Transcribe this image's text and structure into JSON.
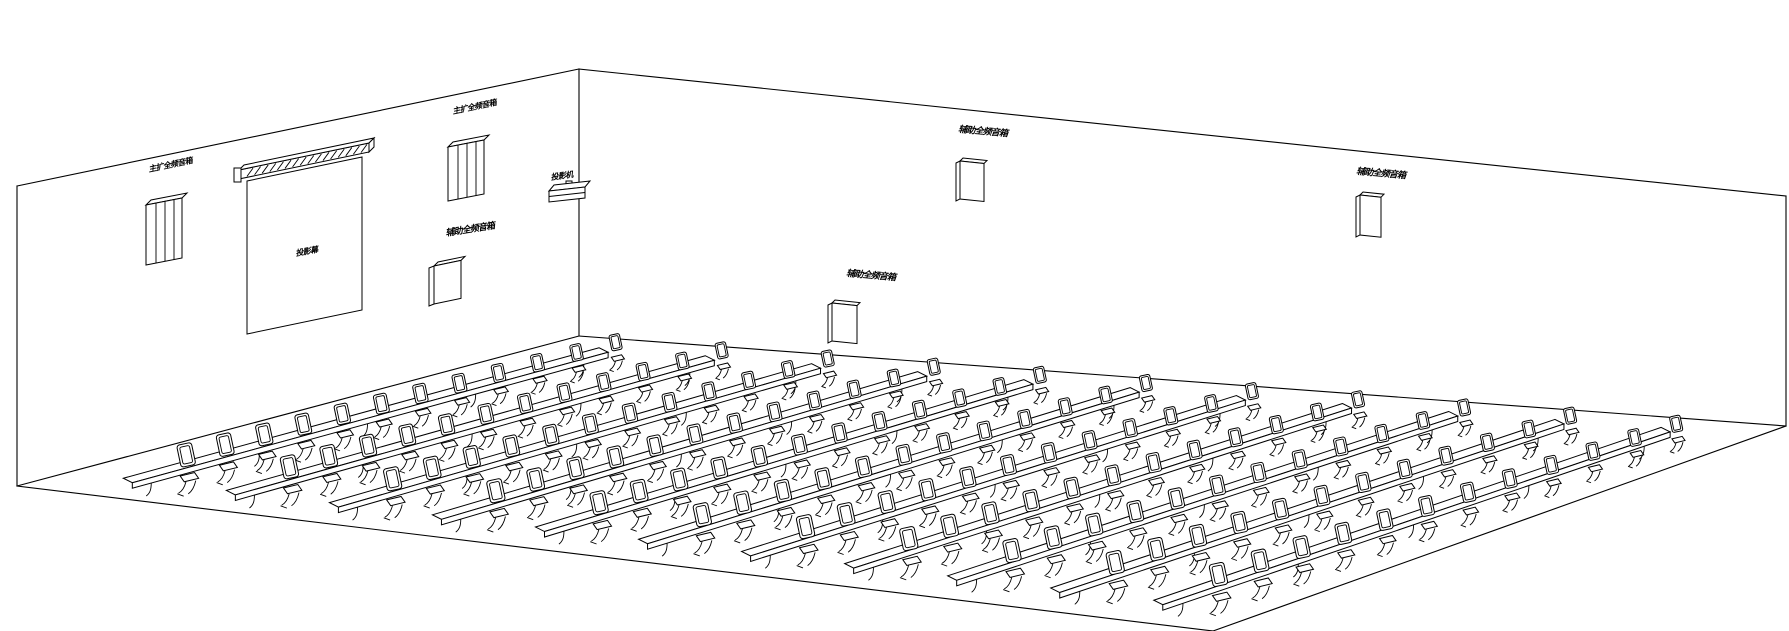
{
  "colors": {
    "background": "#ffffff",
    "line": "#000000"
  },
  "labels": {
    "main_speaker_left": "主扩全频音箱",
    "main_speaker_right": "主扩全频音箱",
    "aux_left_wall": "辅助全频音箱",
    "aux_back_high": "辅助全频音箱",
    "aux_back_mid": "辅助全频音箱",
    "aux_back_right": "辅助全频音箱",
    "projector": "投影机",
    "screen": "投影幕"
  },
  "seating": {
    "rows": 11,
    "seats_per_row": 12
  }
}
